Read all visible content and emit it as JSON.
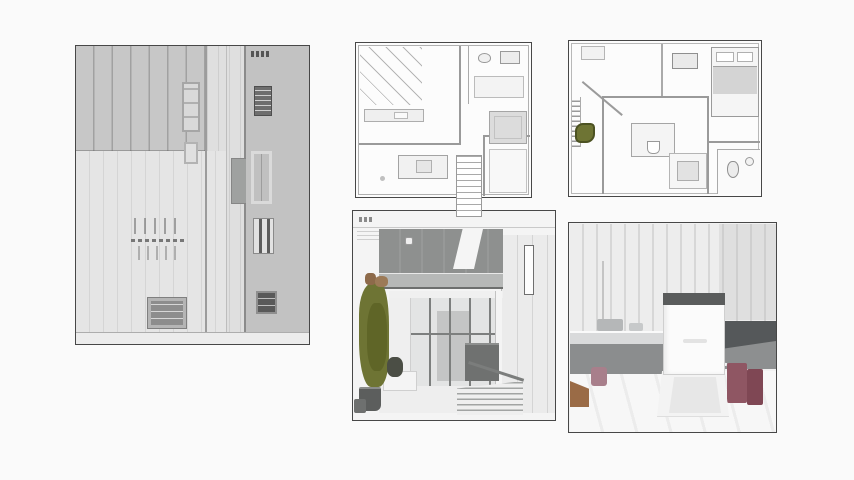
{
  "page": {
    "description": "collage-of-architectural-drawings"
  },
  "colors": {
    "pageBg": "#fafafa",
    "panelBorder": "#474747",
    "elevBase": "#dfdfdf",
    "elevDarkBlock": "#c7c7c7",
    "elevLight": "#e5e5e5",
    "elevStrip": "#c2c2c2",
    "planBg": "#fcfcfc",
    "planWall": "#9a9a9a",
    "planWallSoft": "#b5b5b5",
    "planFill": "#dcdcdc",
    "olive": "#6e7434",
    "oliveDark": "#4c5222",
    "oliveShade": "#5f6527",
    "branchBrown": "#8d6a4a",
    "upperVolumeGray": "#8e908f",
    "balconyGray": "#b6b8b7",
    "glassGray": "#e3e4e4",
    "mullionGray": "#7d7f7e",
    "potGray": "#5c5e5d",
    "shrubDark": "#4b4e45",
    "stepLine": "#a2a4a3",
    "slatWall": "#ededed",
    "slatLine": "#d7d7d7",
    "applianceWhite": "#fbfbfb",
    "applianceBand": "#5a5c5c",
    "counterGray": "#8b8d8e",
    "counterTop": "#d9dadb",
    "cabinetDark": "#55585a",
    "maroon": "#8f5663",
    "maroonDark": "#7f4754",
    "mauve": "#a87f8b",
    "floorBrown": "#9a6b46",
    "floorWhite": "#f7f7f7"
  },
  "panels": [
    {
      "id": "elevation",
      "kind": "building-elevation-drawing"
    },
    {
      "id": "floor-plan-1",
      "kind": "ground-floor-plan-drawing"
    },
    {
      "id": "floor-plan-2",
      "kind": "upper-floor-plan-drawing"
    },
    {
      "id": "exterior-render",
      "kind": "exterior-facade-render"
    },
    {
      "id": "interior-render",
      "kind": "interior-kitchen-render"
    }
  ]
}
